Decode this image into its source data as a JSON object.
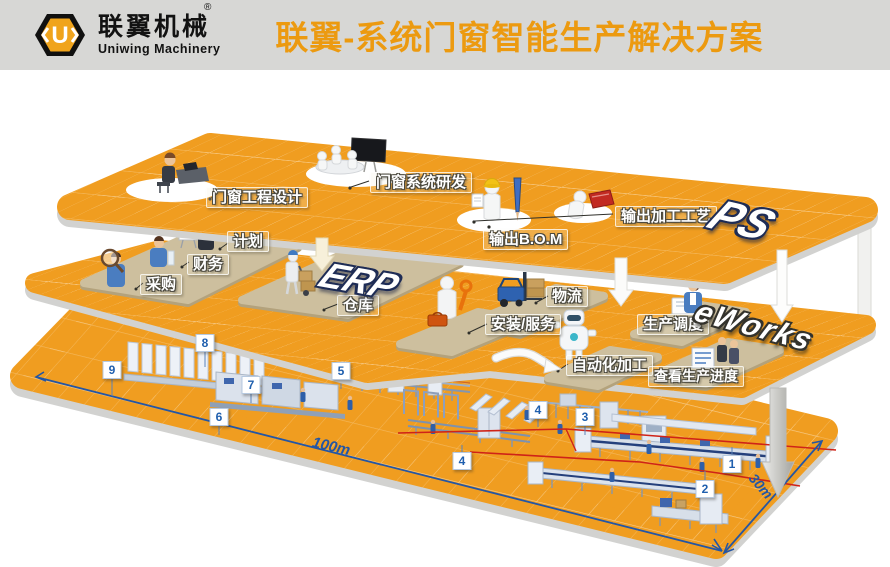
{
  "header": {
    "logo_symbol": "U",
    "registered_mark": "®",
    "company_cn": "联翼机械",
    "company_en": "Uniwing Machinery",
    "title": "联翼-系统门窗智能生产解决方案"
  },
  "platforms": {
    "ps": {
      "logo": "PS",
      "labels": {
        "design": "门窗工程设计",
        "rnd": "门窗系统研发",
        "bom": "输出B.O.M",
        "process": "输出加工工艺"
      }
    },
    "erp": {
      "logo": "ERP",
      "labels": {
        "plan": "计划",
        "finance": "财务",
        "purchase": "采购",
        "warehouse": "仓库",
        "logistics": "物流",
        "install": "安装/服务",
        "dispatch": "生产调度"
      }
    },
    "eworks": {
      "logo": "eWorks",
      "labels": {
        "auto": "自动化加工",
        "progress": "查看生产进度"
      }
    }
  },
  "floor": {
    "markers": [
      "8",
      "9",
      "7",
      "6",
      "5",
      "4",
      "4",
      "3",
      "1",
      "2"
    ],
    "dimensions": {
      "length": "100m",
      "width": "30m"
    }
  },
  "colors": {
    "header_bg": "#d7d7d5",
    "title_orange": "#ec9a10",
    "platform_orange": "#f09d20",
    "pad_tan": "#cdbf9e",
    "marker_blue": "#1f5fae",
    "dimension_blue": "#2456a4",
    "flow_red": "#cf2318"
  }
}
